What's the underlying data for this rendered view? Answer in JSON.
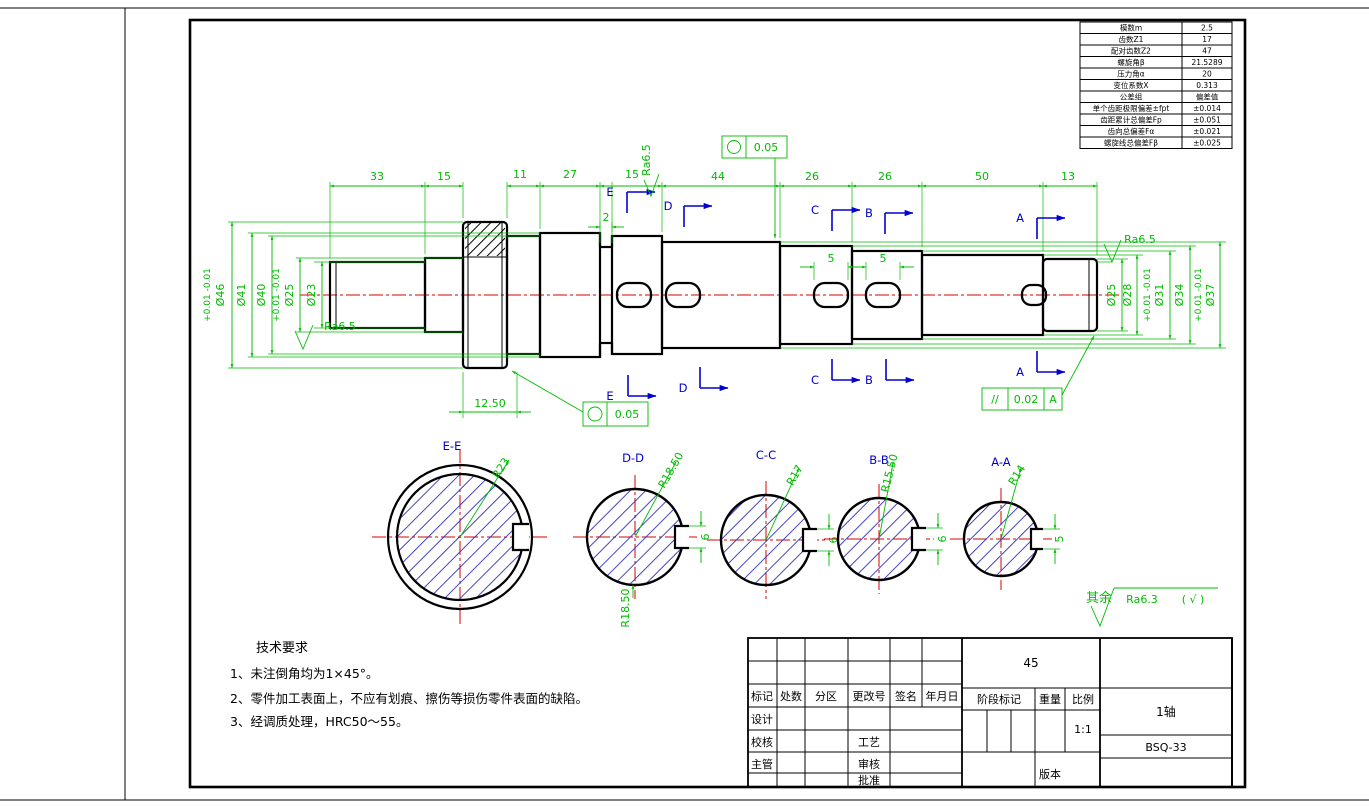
{
  "drawing": {
    "gear_table": {
      "rows": [
        {
          "label": "模数m",
          "value": "2.5"
        },
        {
          "label": "齿数Z1",
          "value": "17"
        },
        {
          "label": "配对齿数Z2",
          "value": "47"
        },
        {
          "label": "螺旋角β",
          "value": "21.5289"
        },
        {
          "label": "压力角α",
          "value": "20"
        },
        {
          "label": "变位系数X",
          "value": "0.313"
        },
        {
          "label": "公差组",
          "value": "偏差值"
        },
        {
          "label": "单个齿距极限偏差±fpt",
          "value": "±0.014"
        },
        {
          "label": "齿距累计总偏差Fp",
          "value": "±0.051"
        },
        {
          "label": "齿向总偏差Fα",
          "value": "±0.021"
        },
        {
          "label": "螺旋线总偏差Fβ",
          "value": "±0.025"
        }
      ]
    },
    "tech": {
      "title": "技术要求",
      "items": [
        "1、未注倒角均为1×45°。",
        "2、零件加工表面上，不应有划痕、擦伤等损伤零件表面的缺陷。",
        "3、经调质处理，HRC50～55。"
      ]
    },
    "dims": {
      "top": [
        "33",
        "15",
        "11",
        "27",
        "15",
        "44",
        "26",
        "26",
        "50",
        "13"
      ],
      "left": [
        {
          "d": "Ø46",
          "tol": "+0.01 -0.01"
        },
        {
          "d": "Ø41",
          "tol": ""
        },
        {
          "d": "Ø40",
          "tol": ""
        },
        {
          "d": "Ø25",
          "tol": "+0.01 -0.01"
        },
        {
          "d": "Ø23",
          "tol": ""
        }
      ],
      "right": [
        {
          "d": "Ø25",
          "tol": ""
        },
        {
          "d": "Ø28",
          "tol": ""
        },
        {
          "d": "Ø31",
          "tol": "+0.01 -0.01"
        },
        {
          "d": "Ø34",
          "tol": ""
        },
        {
          "d": "Ø37",
          "tol": "+0.01 -0.01"
        }
      ],
      "flange_width": "12.50",
      "groove": "2",
      "key_c": "5",
      "key_b": "5"
    },
    "sections": [
      {
        "id": "E-E",
        "radius": "R23",
        "kw": ""
      },
      {
        "id": "D-D",
        "radius": "R18.50",
        "radius2": "R18.50",
        "kw": "6"
      },
      {
        "id": "C-C",
        "radius": "R17",
        "kw": "6"
      },
      {
        "id": "B-B",
        "radius": "R15.50",
        "kw": "6"
      },
      {
        "id": "A-A",
        "radius": "R14",
        "kw": "5"
      }
    ],
    "markers": {
      "a": "A",
      "b": "B",
      "c": "C",
      "d": "D",
      "e": "E"
    },
    "tolerances": {
      "circ_top": "0.05",
      "circ_mid": "0.05",
      "par_sym": "//",
      "par_val": "0.02",
      "par_datum": "A"
    },
    "surface": {
      "ra_left": "Ra6.5",
      "ra_mid": "Ra6.5",
      "ra_right": "Ra6.5",
      "rest_label": "其余",
      "rest_value": "Ra6.3",
      "rest_suffix": "( √ )"
    },
    "title_block": {
      "material": "45",
      "rev_headers": [
        "标记",
        "处数",
        "分区",
        "更改号",
        "签名",
        "年月日"
      ],
      "design": "设计",
      "check": "校核",
      "chief": "主管",
      "craft": "工艺",
      "audit": "审核",
      "approve": "批准",
      "stage": "阶段标记",
      "weight": "重量",
      "scale": "比例",
      "scale_value": "1:1",
      "part_name": "1轴",
      "drawing_no": "BSQ-33",
      "version": "版本"
    }
  }
}
